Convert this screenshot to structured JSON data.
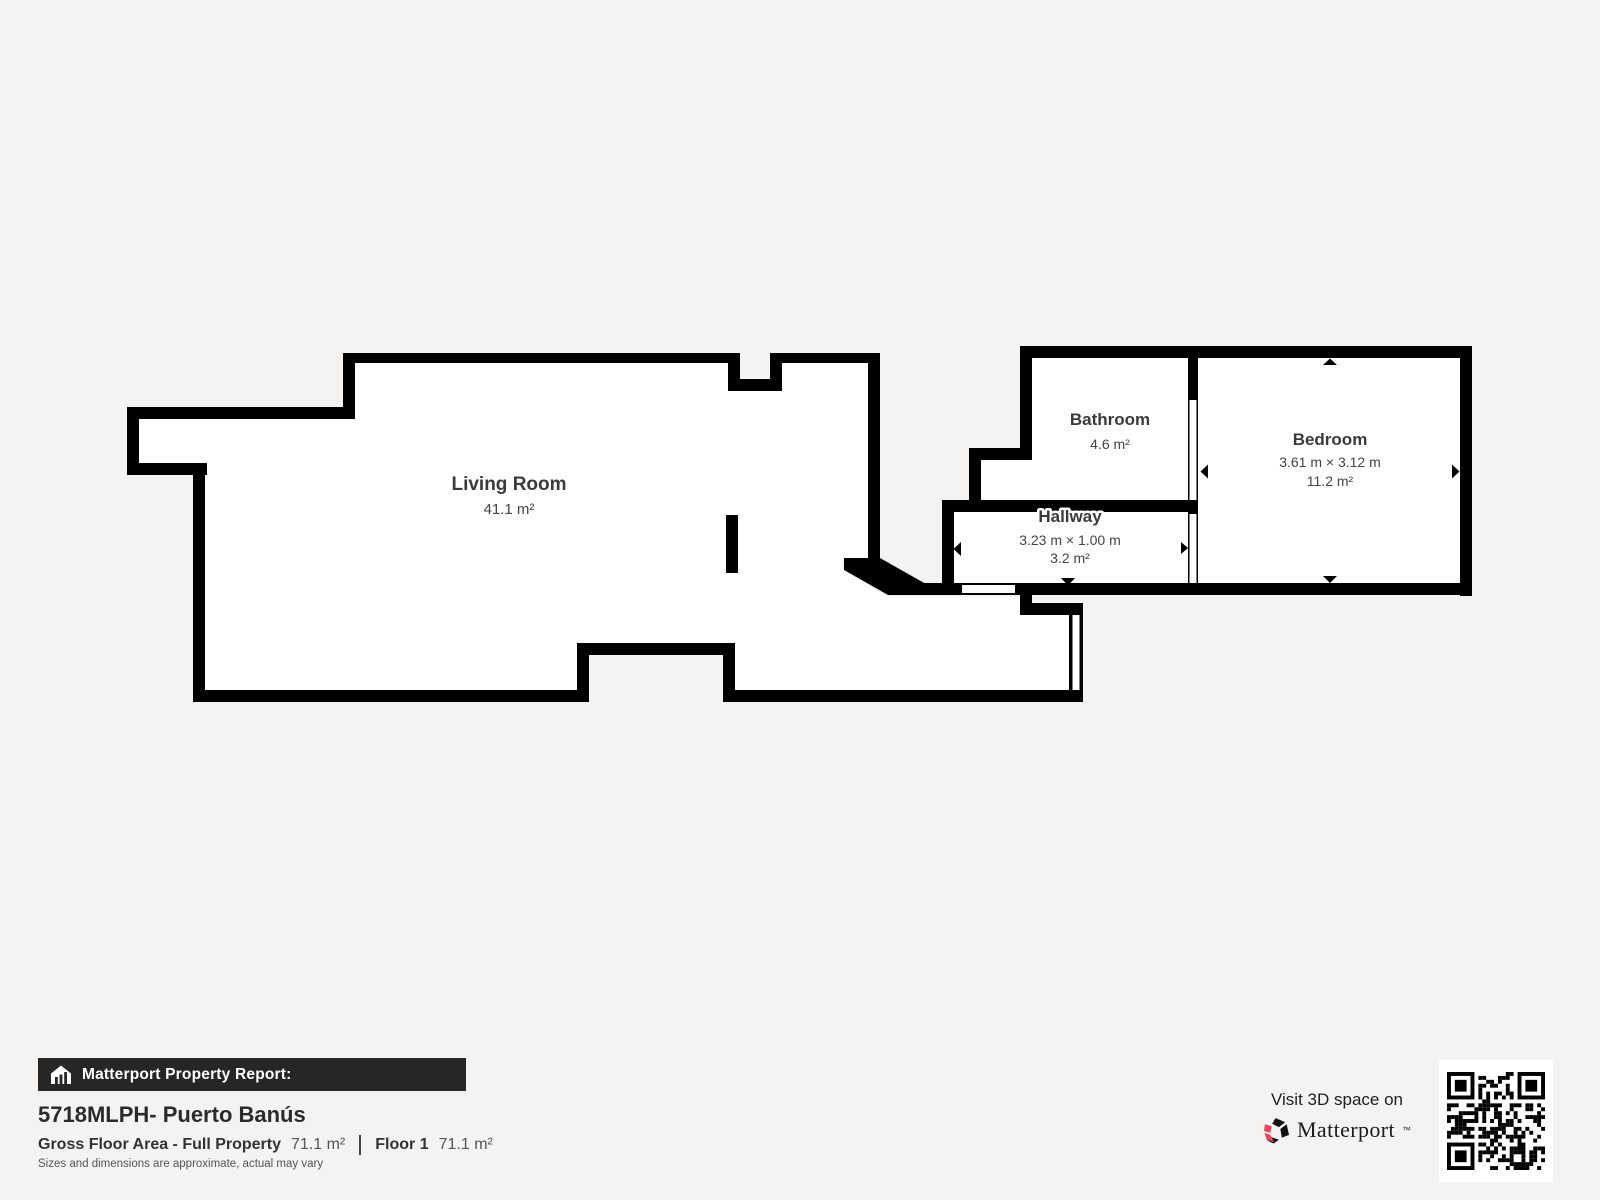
{
  "page": {
    "background": "#f4f3f1",
    "wall_color": "#000000",
    "brand_pink": "#f0435c",
    "banner_bg": "#262626"
  },
  "floorplan": {
    "rooms": [
      {
        "id": "living-room",
        "name": "Living Room",
        "area": "41.1 m²"
      },
      {
        "id": "bathroom",
        "name": "Bathroom",
        "area": "4.6 m²"
      },
      {
        "id": "bedroom",
        "name": "Bedroom",
        "dimensions": "3.61 m × 3.12 m",
        "area": "11.2 m²"
      },
      {
        "id": "hallway",
        "name": "Hallway",
        "dimensions": "3.23 m × 1.00 m",
        "area": "3.2 m²"
      }
    ]
  },
  "report": {
    "banner": "Matterport Property Report:",
    "property_title": "5718MLPH- Puerto Banús",
    "gross_label": "Gross Floor Area - Full Property",
    "gross_value": "71.1 m²",
    "floor_label": "Floor 1",
    "floor_value": "71.1 m²",
    "disclaimer": "Sizes and dimensions are approximate, actual may vary"
  },
  "cta": {
    "line": "Visit 3D space on",
    "brand": "Matterport",
    "brand_mark": "™"
  }
}
